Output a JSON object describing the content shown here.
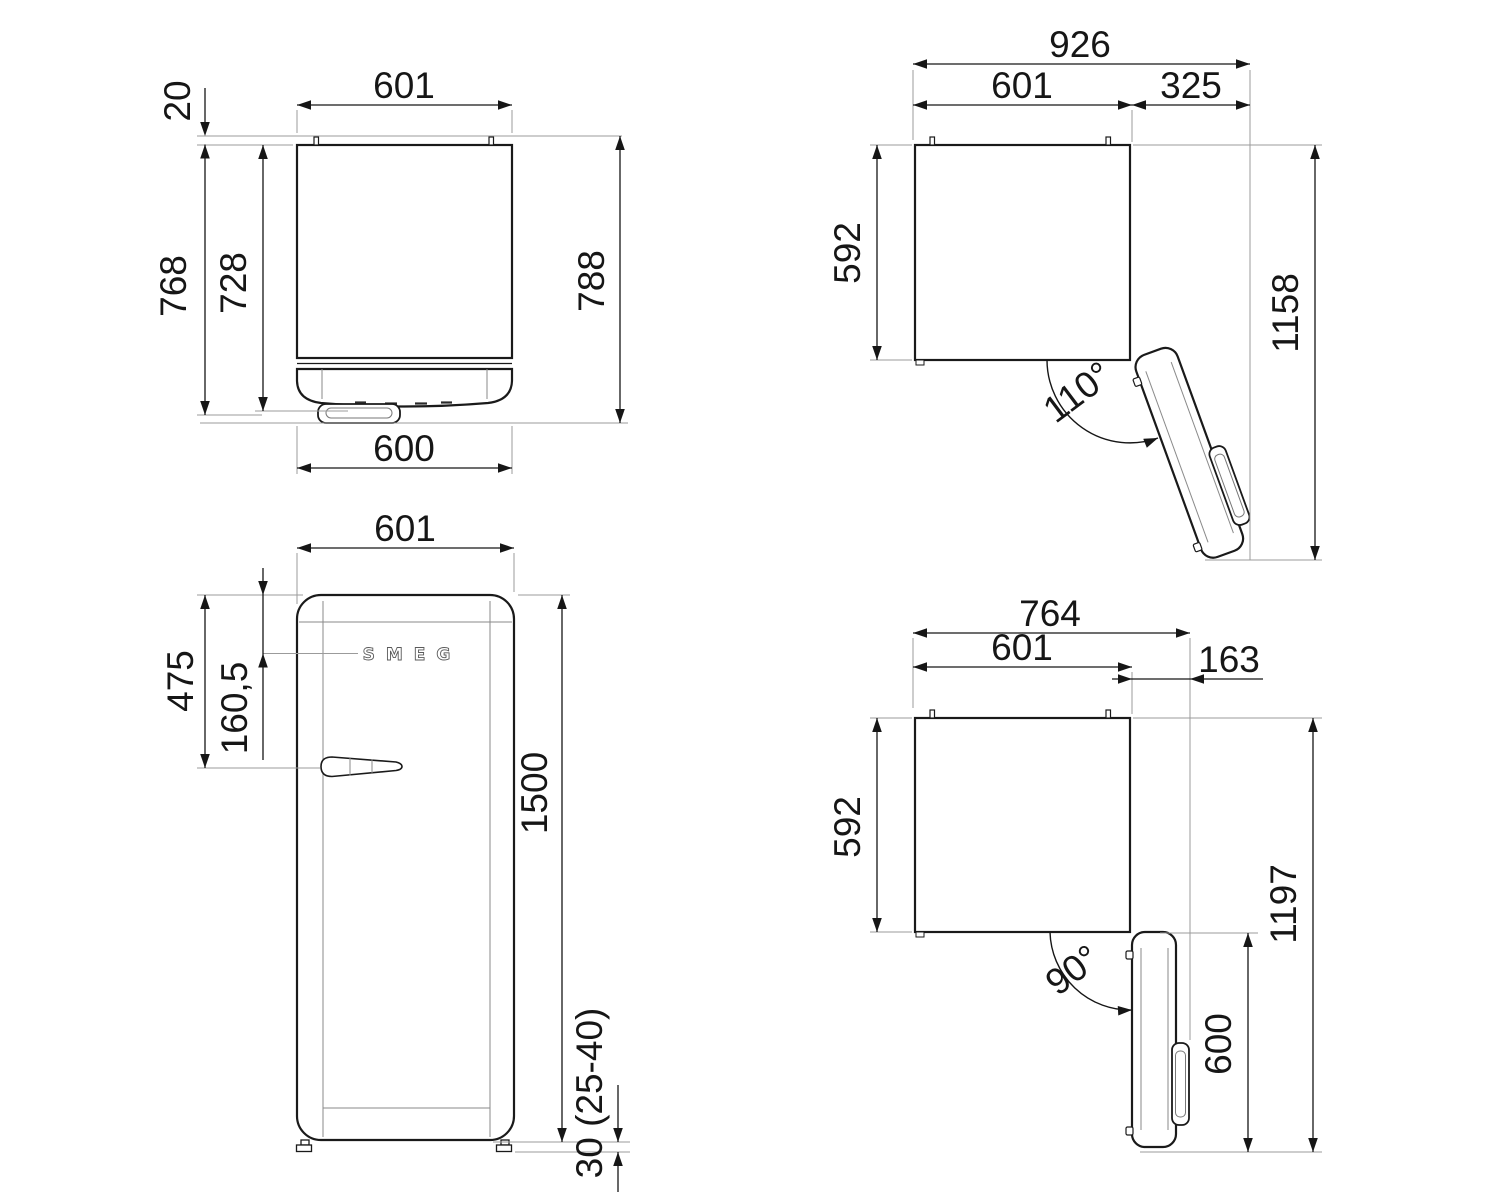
{
  "title": "Refrigerator dimension drawing",
  "colors": {
    "line": "#1a1a1a",
    "extension": "#9b9b9b",
    "background": "#ffffff"
  },
  "v1": {
    "width_top": "601",
    "pin_protrusion": "20",
    "depth_total": "768",
    "depth_body": "728",
    "depth_with_handle": "788",
    "door_width": "600"
  },
  "v2": {
    "overall_width": "926",
    "body_width": "601",
    "door_extension": "325",
    "body_depth": "592",
    "overall_depth": "1158",
    "door_angle": "110°"
  },
  "v3": {
    "width": "601",
    "handle_height_from_top": "475",
    "logo_height_from_top": "160,5",
    "height": "1500",
    "feet_height": "30 (25-40)",
    "logo": "SMEG"
  },
  "v4": {
    "overall_width": "764",
    "body_width": "601",
    "door_extension": "163",
    "body_depth": "592",
    "overall_depth": "1197",
    "door_depth": "600",
    "door_angle": "90°"
  }
}
